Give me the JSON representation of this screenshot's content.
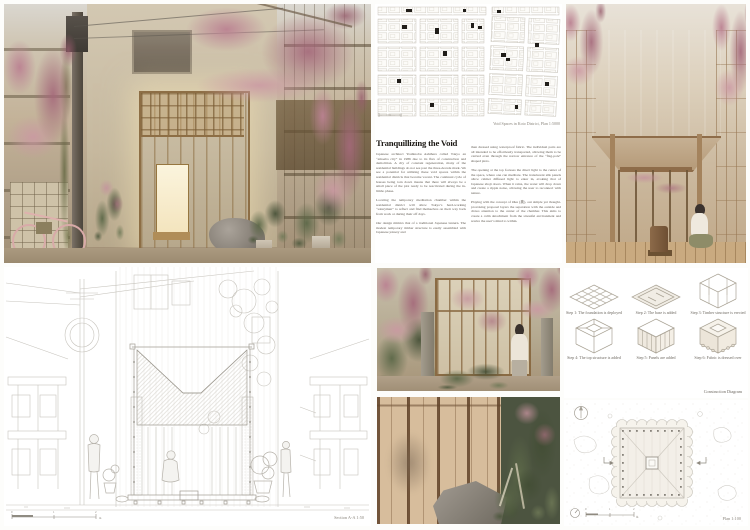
{
  "poster": {
    "title": "Tranquillizing the Void"
  },
  "palette": {
    "blossom_pink": "#b8808e",
    "timber": "#a8855c",
    "lantern_glow": "#f2e3bd",
    "foliage_green": "#66704f",
    "drawing_line": "#c7c4bd"
  },
  "map_panel": {
    "caption": "Void Spaces in Koto District, Plan 1:5000"
  },
  "essay": {
    "title": "Tranquillizing the Void",
    "col_left": [
      "Japanese architect Yoshinobu Ashihara called Tokyo an “amoeba city” in 1986 due to its flux of construction and demolition. A city of constant regeneration, many of the residential buildings do not see past the three-decade mark. We see a potential for utilizing these void spaces within the residential districts that become vacant. The continual cycle of houses being torn down means that there will always be a small piece of the plot ready to be reactivated during the in-limbo phase.",
      "Locating the temporary meditation chamber within the residential district will allow Tokyo’s hard-working “salarymen” to reflect and find themselves on their way back from work or during their off days.",
      "Our design mimics that of a traditional Japanese lantern. The modest temporary timber structure is easily assembled with Japanese joinery and"
    ],
    "col_right": [
      "then dressed using waterproof fabric. The individual parts are all intended to be effortlessly transported, allowing them to be carried even through the narrow entrance of the “flag-pole” shaped plots.",
      "The opening at the top focuses the direct light to the center of the space, where one can meditate. The translucent silk panels allow calmer diffused light to enter in, evoking that of Japanese shoji doors. When it rains, the water will drop down and create a ripple noise, allowing the user to reconnect with nature.",
      "Playing with the concept of Oku (奥), our simple yet thought-provoking proposal layers the separation with the outside and draws attention to the center of the chamber. This aims to create a calm detachment from the stressful environment and rewire the user’s mind to within."
    ]
  },
  "section_panel": {
    "caption": "Section A-A 1:50",
    "scale": {
      "t0": "0",
      "t1": "1",
      "t2": "2",
      "unit": "m"
    }
  },
  "construction_panel": {
    "caption": "Construction Diagram",
    "steps": [
      "Step 1: The foundation is deployed",
      "Step 2: The base is added",
      "Step 3: Timber structure is erected",
      "Step 4: The top structure is added",
      "Step 5: Panels are added",
      "Step 6: Fabric is dressed over"
    ]
  },
  "plan_panel": {
    "caption": "Plan 1:100",
    "scale": {
      "t0": "0",
      "t1": "1",
      "t2": "2",
      "unit": "m"
    }
  }
}
